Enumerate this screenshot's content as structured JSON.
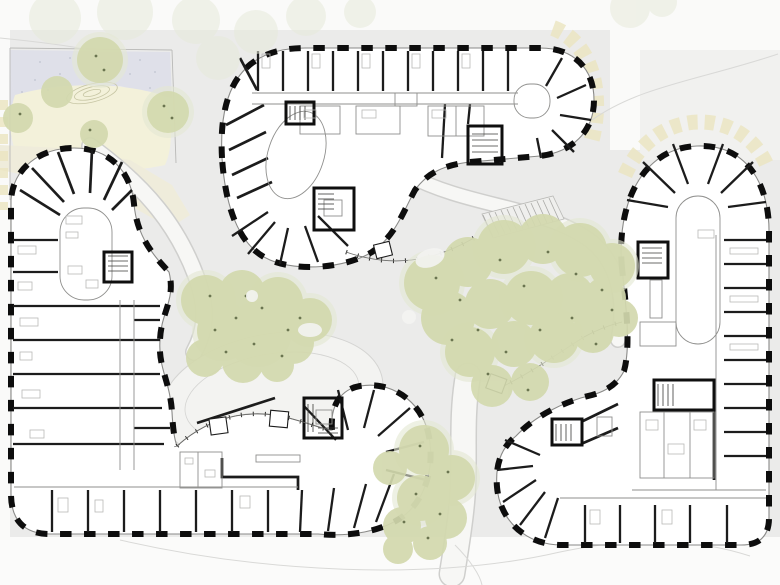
{
  "page": {
    "description": "Architectural site floor plan: three organic curved residential buildings with pier facades arranged around a landscaped courtyard with trees, paths, a garden lawn with mound, and an access ramp"
  },
  "scene": {
    "areas": [
      "garden-lawn",
      "central-courtyard",
      "pedestrian-paths",
      "ramp"
    ],
    "buildings": [
      "north-building",
      "west-building",
      "east-building"
    ],
    "tree_clusters": 4,
    "hedges": 2
  },
  "colors": {
    "site_bg": "#ebebea",
    "white_zone": "#fafaf9",
    "corner_panel": "#f1f1ef",
    "bottom_zone": "#fbfbfa",
    "lawn": "#dfe0e9",
    "lawn_dot": "#c7c9d6",
    "mound": "#f3f1da",
    "contour": "#c6c5a3",
    "cream_band": "#efecdb",
    "hedge": "#ebe5bf",
    "path_fill": "#f7f7f5",
    "path_edge": "#cfcfcd",
    "faint_line": "#d9d9d7",
    "oval_fill": "#f3f3f1",
    "oval_edge": "#d4d4d2",
    "ramp_fill": "#efefed",
    "ramp_edge": "#b9b9b6",
    "ramp_hatch": "#a9a9a6",
    "building_fill": "#ffffff",
    "building_outline": "#8a8a88",
    "pier": "#0d0d0d",
    "partition": "#1c1c1c",
    "fine_line": "#8f8f8d",
    "furniture": "#b9b9b7",
    "core": "#0f0f0f",
    "stair_hatch": "#3a3a38",
    "glass_fine": "#6a6a68",
    "glass_tick": "#2a2a28",
    "tree": "#d3d9ae",
    "tree_halo": "#e4e8d3",
    "tree_faded": "#e7eadb",
    "tree_dot": "#6b7550",
    "white_patch": "#f4f4f2"
  }
}
